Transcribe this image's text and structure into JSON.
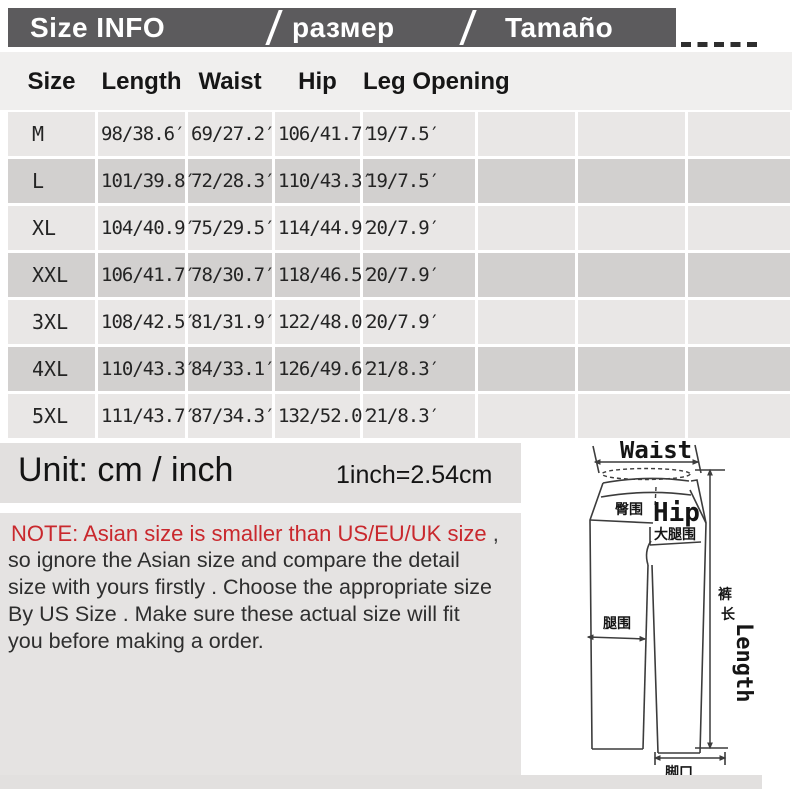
{
  "titlebar": {
    "items": [
      "Size INFO",
      "размер",
      "Tamaño"
    ],
    "bar_color": "#5c5b5d"
  },
  "table": {
    "headers": [
      "Size",
      "Length",
      "Waist",
      "Hip",
      "Leg Opening"
    ],
    "rows": [
      {
        "size": "M",
        "length": "98/38.6′",
        "waist": "69/27.2′",
        "hip": "106/41.7′",
        "leg": "19/7.5′"
      },
      {
        "size": "L",
        "length": "101/39.8′",
        "waist": "72/28.3′",
        "hip": "110/43.3′",
        "leg": "19/7.5′"
      },
      {
        "size": "XL",
        "length": "104/40.9′",
        "waist": "75/29.5′",
        "hip": "114/44.9′",
        "leg": "20/7.9′"
      },
      {
        "size": "XXL",
        "length": "106/41.7′",
        "waist": "78/30.7′",
        "hip": "118/46.5′",
        "leg": "20/7.9′"
      },
      {
        "size": "3XL",
        "length": "108/42.5′",
        "waist": "81/31.9′",
        "hip": "122/48.0′",
        "leg": "20/7.9′"
      },
      {
        "size": "4XL",
        "length": "110/43.3′",
        "waist": "84/33.1′",
        "hip": "126/49.6′",
        "leg": "21/8.3′"
      },
      {
        "size": "5XL",
        "length": "111/43.7′",
        "waist": "87/34.3′",
        "hip": "132/52.0′",
        "leg": "21/8.3′"
      }
    ],
    "row_color_light": "#e9e7e6",
    "row_color_dark": "#d2d0cf"
  },
  "unit": {
    "label": "Unit: cm / inch",
    "conversion": "1inch=2.54cm"
  },
  "note": {
    "headline": "NOTE: Asian size is smaller than US/EU/UK size",
    "headline_suffix": " ,",
    "headline_color": "#c9282d",
    "lines": [
      " so ignore the Asian size and compare the detail",
      "size with yours firstly . Choose the appropriate size",
      "By US Size . Make sure these actual size will fit",
      "you before making a order."
    ]
  },
  "diagram": {
    "waist_label": "Waist",
    "hip_label": "Hip",
    "hip_cn": "臀围",
    "thigh_cn": "大腿围",
    "leg_cn": "腿围",
    "leg_opening_cn": "脚口",
    "length_cn_1": "裤",
    "length_cn_2": "长",
    "length_label": "Length"
  }
}
